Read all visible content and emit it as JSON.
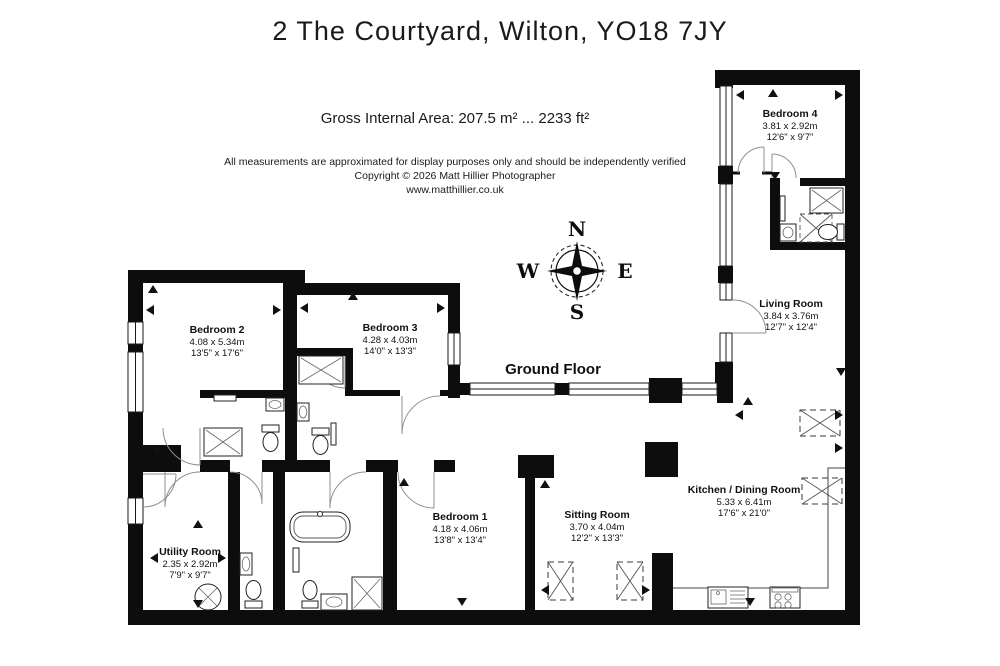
{
  "title": "2 The Courtyard, Wilton, YO18 7JY",
  "area_line": "Gross Internal Area: 207.5 m² ... 2233 ft²",
  "disclaimer": {
    "line1": "All measurements are approximated for display purposes only and should be independently verified",
    "line2": "Copyright © 2026 Matt Hillier Photographer",
    "line3": "www.matthillier.co.uk"
  },
  "floor_label": "Ground Floor",
  "compass": {
    "north": "N",
    "east": "E",
    "south": "S",
    "west": "W"
  },
  "rooms": [
    {
      "id": "bedroom-2",
      "name": "Bedroom 2",
      "metric": "4.08 x 5.34m",
      "imperial": "13'5\" x 17'6\""
    },
    {
      "id": "bedroom-3",
      "name": "Bedroom 3",
      "metric": "4.28 x 4.03m",
      "imperial": "14'0\" x 13'3\""
    },
    {
      "id": "bedroom-4",
      "name": "Bedroom 4",
      "metric": "3.81 x 2.92m",
      "imperial": "12'6\" x 9'7\""
    },
    {
      "id": "living-room",
      "name": "Living Room",
      "metric": "3.84 x 3.76m",
      "imperial": "12'7\" x 12'4\""
    },
    {
      "id": "kitchen-dining-room",
      "name": "Kitchen / Dining Room",
      "metric": "5.33 x 6.41m",
      "imperial": "17'6\" x 21'0\""
    },
    {
      "id": "sitting-room",
      "name": "Sitting Room",
      "metric": "3.70 x 4.04m",
      "imperial": "12'2\" x 13'3\""
    },
    {
      "id": "bedroom-1",
      "name": "Bedroom 1",
      "metric": "4.18 x 4.06m",
      "imperial": "13'8\" x 13'4\""
    },
    {
      "id": "utility-room",
      "name": "Utility Room",
      "metric": "2.35 x 2.92m",
      "imperial": "7'9\" x 9'7\""
    }
  ],
  "colors": {
    "wall": "#0d0d0d",
    "background": "#ffffff"
  }
}
